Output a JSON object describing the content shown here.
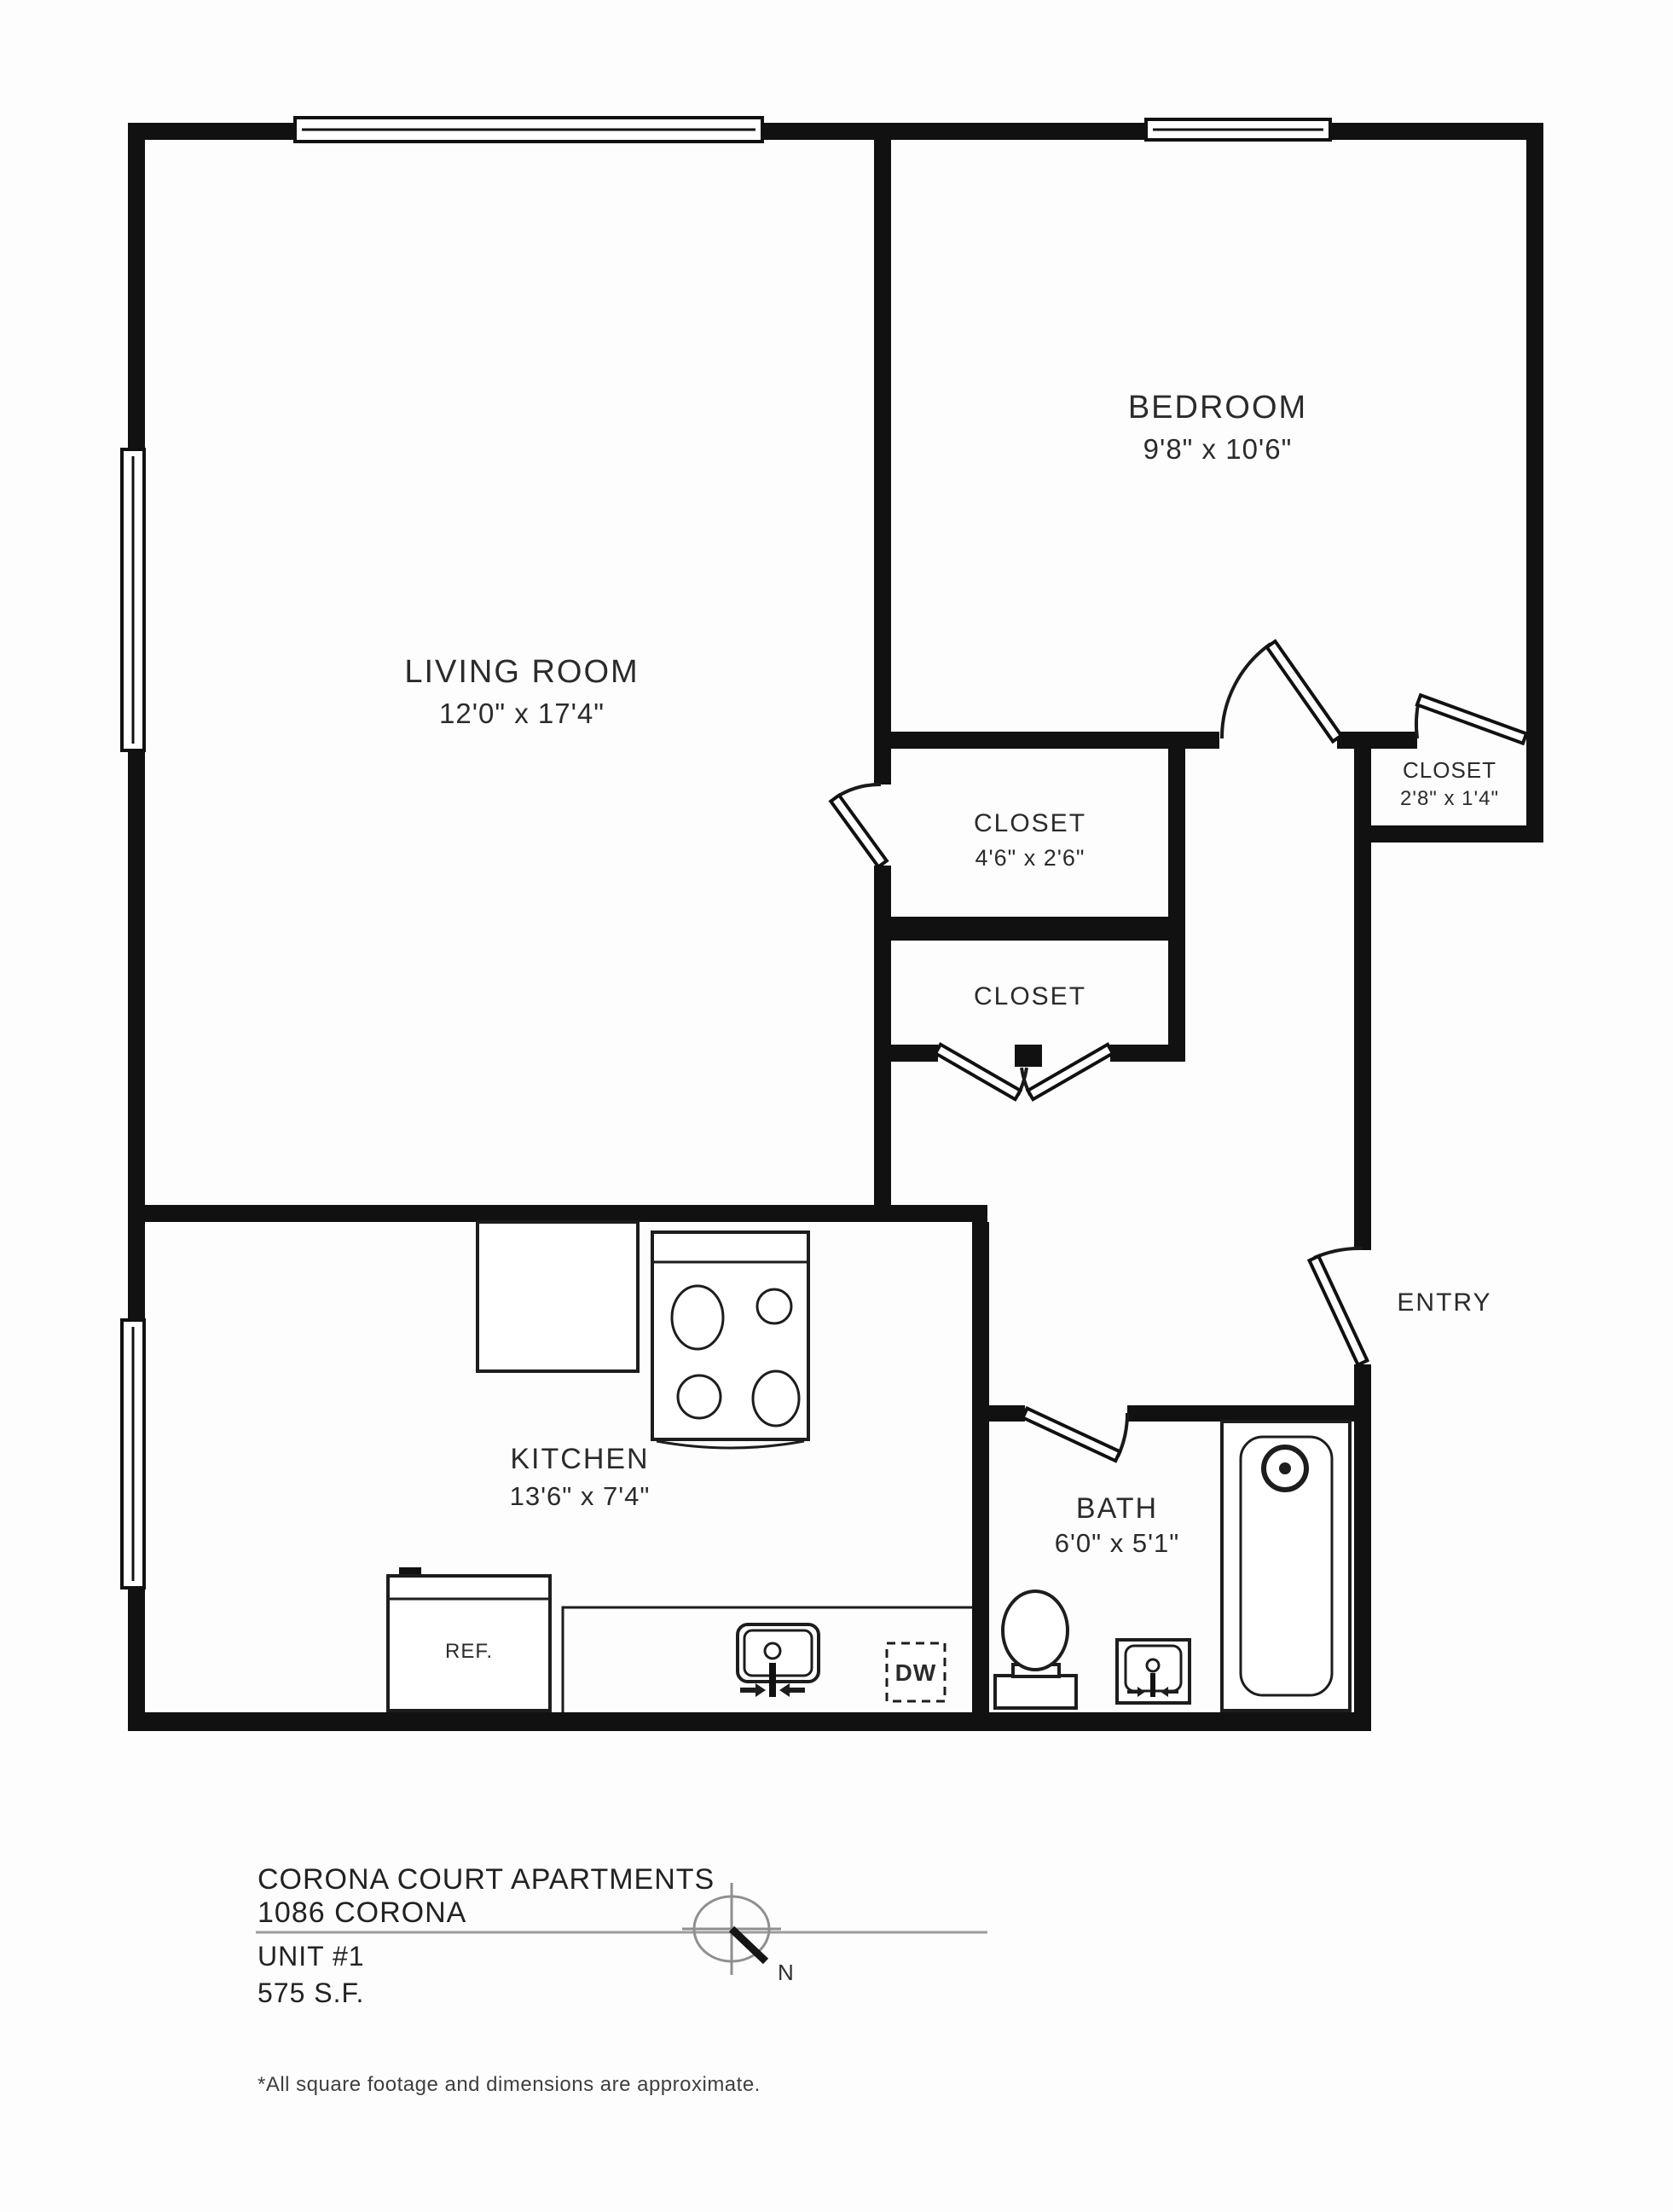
{
  "plan": {
    "rooms": {
      "living": {
        "name": "LIVING ROOM",
        "dims": "12'0\" x 17'4\""
      },
      "bedroom": {
        "name": "BEDROOM",
        "dims": "9'8\" x 10'6\""
      },
      "kitchen": {
        "name": "KITCHEN",
        "dims": "13'6\" x 7'4\""
      },
      "bath": {
        "name": "BATH",
        "dims": "6'0\" x 5'1\""
      },
      "entry": {
        "name": "ENTRY"
      },
      "closet_main": {
        "name": "CLOSET",
        "dims": "4'6\" x 2'6\""
      },
      "closet_lower": {
        "name": "CLOSET"
      },
      "closet_bedroom": {
        "name": "CLOSET",
        "dims": "2'8\" x 1'4\""
      }
    },
    "fixtures": {
      "refrigerator": "REF.",
      "dishwasher": "DW"
    }
  },
  "title_block": {
    "building": "CORONA COURT APARTMENTS",
    "address": "1086 CORONA",
    "unit": "UNIT #1",
    "area": "575 S.F."
  },
  "compass": {
    "north_label": "N"
  },
  "footer": {
    "disclaimer": "*All square footage and dimensions are approximate."
  },
  "colors": {
    "wall": "#111111",
    "background": "#fdfdfd",
    "text": "#2b2b2b",
    "compass_gray": "#8f8f8f"
  }
}
